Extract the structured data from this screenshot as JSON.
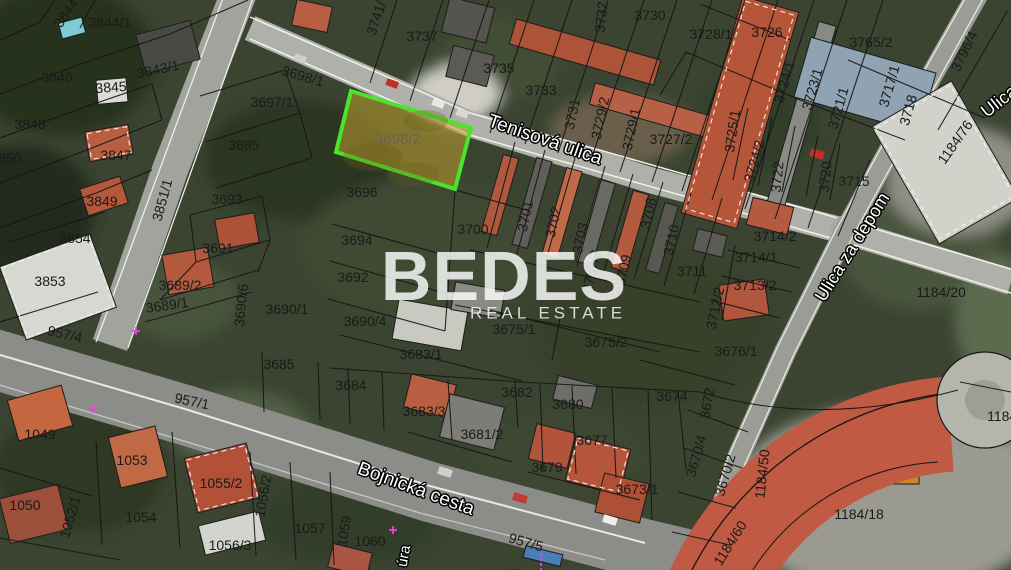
{
  "watermark": {
    "title": "BEDES",
    "subtitle": "REAL ESTATE"
  },
  "map": {
    "highlight": {
      "parcel_id": "3698/2",
      "border_color": "#4be32b",
      "fill_color": "#c0a02e",
      "label_color": "#6e5f4e",
      "polygon": "351,91 471,128 455,189 336,152",
      "label_x": 398,
      "label_y": 139
    },
    "marker_color": "#f03df0",
    "streets": [
      {
        "name": "Tenisová ulica",
        "x": 545,
        "y": 140,
        "r": 19,
        "size": 19
      },
      {
        "name": "Bojnická cesta",
        "x": 416,
        "y": 489,
        "r": 20,
        "size": 19
      },
      {
        "name": "Ulica za depom",
        "x": 852,
        "y": 247,
        "r": -58,
        "size": 18
      },
      {
        "name": "Ulica",
        "x": 999,
        "y": 101,
        "r": -38,
        "size": 18
      },
      {
        "name": "úra",
        "x": 404,
        "y": 556,
        "r": -80,
        "size": 15
      }
    ],
    "parcels": [
      {
        "id": "3844",
        "x": 66,
        "y": 13,
        "r": -55
      },
      {
        "id": "3844/1",
        "x": 110,
        "y": 22,
        "r": 0
      },
      {
        "id": "3843/1",
        "x": 158,
        "y": 69,
        "r": -12
      },
      {
        "id": "3846",
        "x": 57,
        "y": 77,
        "r": 0
      },
      {
        "id": "3845",
        "x": 111,
        "y": 87,
        "r": -4
      },
      {
        "id": "3848",
        "x": 30,
        "y": 124,
        "r": 0
      },
      {
        "id": "3850",
        "x": 6,
        "y": 158,
        "r": 0
      },
      {
        "id": "3847",
        "x": 116,
        "y": 155,
        "r": 0
      },
      {
        "id": "3695",
        "x": 244,
        "y": 145,
        "r": 0
      },
      {
        "id": "3697/1",
        "x": 272,
        "y": 102,
        "r": 0
      },
      {
        "id": "3698/1",
        "x": 303,
        "y": 76,
        "r": 16
      },
      {
        "id": "3851/1",
        "x": 162,
        "y": 200,
        "r": -75
      },
      {
        "id": "3741/",
        "x": 376,
        "y": 18,
        "r": -72
      },
      {
        "id": "3737",
        "x": 422,
        "y": 36,
        "r": 0
      },
      {
        "id": "3735",
        "x": 499,
        "y": 68,
        "r": 0
      },
      {
        "id": "3733",
        "x": 541,
        "y": 90,
        "r": 0
      },
      {
        "id": "3731",
        "x": 572,
        "y": 114,
        "r": -78
      },
      {
        "id": "3732",
        "x": 601,
        "y": 17,
        "r": -84
      },
      {
        "id": "3730",
        "x": 650,
        "y": 15,
        "r": 0
      },
      {
        "id": "3729/2",
        "x": 600,
        "y": 118,
        "r": -78
      },
      {
        "id": "3729/1",
        "x": 631,
        "y": 129,
        "r": -78
      },
      {
        "id": "3727/2",
        "x": 671,
        "y": 139,
        "r": 0
      },
      {
        "id": "3728/1",
        "x": 711,
        "y": 34,
        "r": 0
      },
      {
        "id": "3726",
        "x": 767,
        "y": 32,
        "r": 0
      },
      {
        "id": "3765/2",
        "x": 871,
        "y": 42,
        "r": 0
      },
      {
        "id": "3724/1",
        "x": 784,
        "y": 82,
        "r": -74
      },
      {
        "id": "3723/1",
        "x": 812,
        "y": 89,
        "r": -74
      },
      {
        "id": "3721/1",
        "x": 838,
        "y": 108,
        "r": -74
      },
      {
        "id": "3717/1",
        "x": 889,
        "y": 86,
        "r": -74
      },
      {
        "id": "3718",
        "x": 908,
        "y": 110,
        "r": -74
      },
      {
        "id": "3796/4",
        "x": 964,
        "y": 51,
        "r": -64
      },
      {
        "id": "1184/76",
        "x": 955,
        "y": 142,
        "r": -55
      },
      {
        "id": "3725/1",
        "x": 732,
        "y": 131,
        "r": -82
      },
      {
        "id": "3724/2",
        "x": 754,
        "y": 161,
        "r": -74
      },
      {
        "id": "3722",
        "x": 777,
        "y": 177,
        "r": -84
      },
      {
        "id": "3720",
        "x": 825,
        "y": 177,
        "r": -84
      },
      {
        "id": "3715",
        "x": 854,
        "y": 181,
        "r": 0
      },
      {
        "id": "3696",
        "x": 362,
        "y": 192,
        "r": 0
      },
      {
        "id": "3700",
        "x": 473,
        "y": 229,
        "r": 0
      },
      {
        "id": "3694",
        "x": 357,
        "y": 240,
        "r": 0
      },
      {
        "id": "3692",
        "x": 353,
        "y": 277,
        "r": 0
      },
      {
        "id": "3849",
        "x": 102,
        "y": 201,
        "r": 0
      },
      {
        "id": "3854",
        "x": 75,
        "y": 238,
        "r": 0
      },
      {
        "id": "3853",
        "x": 50,
        "y": 281,
        "r": 0
      },
      {
        "id": "3693",
        "x": 227,
        "y": 199,
        "r": 0
      },
      {
        "id": "3691",
        "x": 218,
        "y": 248,
        "r": 0
      },
      {
        "id": "3689/2",
        "x": 180,
        "y": 285,
        "r": 0
      },
      {
        "id": "3689/1",
        "x": 167,
        "y": 305,
        "r": -8
      },
      {
        "id": "3690/6",
        "x": 241,
        "y": 305,
        "r": -84
      },
      {
        "id": "3690/1",
        "x": 287,
        "y": 309,
        "r": 0
      },
      {
        "id": "957/4",
        "x": 65,
        "y": 334,
        "r": 13
      },
      {
        "id": "3690/4",
        "x": 365,
        "y": 321,
        "r": 0
      },
      {
        "id": "3675/1",
        "x": 514,
        "y": 329,
        "r": 0
      },
      {
        "id": "3675/2",
        "x": 606,
        "y": 342,
        "r": 0
      },
      {
        "id": "3683/1",
        "x": 421,
        "y": 354,
        "r": 0
      },
      {
        "id": "3685",
        "x": 279,
        "y": 364,
        "r": 0
      },
      {
        "id": "3701",
        "x": 525,
        "y": 216,
        "r": -78
      },
      {
        "id": "3702",
        "x": 553,
        "y": 222,
        "r": -78
      },
      {
        "id": "3703",
        "x": 580,
        "y": 238,
        "r": -78
      },
      {
        "id": "3707/2",
        "x": 591,
        "y": 271,
        "r": -78
      },
      {
        "id": "3709",
        "x": 623,
        "y": 270,
        "r": -78
      },
      {
        "id": "3708",
        "x": 648,
        "y": 213,
        "r": -78
      },
      {
        "id": "3710",
        "x": 671,
        "y": 240,
        "r": -78
      },
      {
        "id": "3711",
        "x": 692,
        "y": 271,
        "r": 0
      },
      {
        "id": "3714/2",
        "x": 775,
        "y": 236,
        "r": 0
      },
      {
        "id": "3714/1",
        "x": 756,
        "y": 257,
        "r": 0
      },
      {
        "id": "3713/2",
        "x": 755,
        "y": 285,
        "r": 0
      },
      {
        "id": "3712/2",
        "x": 715,
        "y": 308,
        "r": -78
      },
      {
        "id": "1184/20",
        "x": 941,
        "y": 292,
        "r": 0
      },
      {
        "id": "3676/1",
        "x": 736,
        "y": 351,
        "r": 0
      },
      {
        "id": "957/1",
        "x": 192,
        "y": 401,
        "r": 12
      },
      {
        "id": "1049",
        "x": 40,
        "y": 434,
        "r": 0
      },
      {
        "id": "1053",
        "x": 132,
        "y": 460,
        "r": 0
      },
      {
        "id": "1050",
        "x": 25,
        "y": 505,
        "r": 0
      },
      {
        "id": "1052/1",
        "x": 70,
        "y": 517,
        "r": -74
      },
      {
        "id": "1054",
        "x": 141,
        "y": 517,
        "r": 0
      },
      {
        "id": "1055/2",
        "x": 221,
        "y": 483,
        "r": 0
      },
      {
        "id": "1056/2",
        "x": 263,
        "y": 496,
        "r": -80
      },
      {
        "id": "1056/3",
        "x": 230,
        "y": 545,
        "r": 0
      },
      {
        "id": "1057",
        "x": 310,
        "y": 528,
        "r": 0
      },
      {
        "id": "1059",
        "x": 344,
        "y": 531,
        "r": -80
      },
      {
        "id": "1060",
        "x": 370,
        "y": 541,
        "r": 0
      },
      {
        "id": "3684",
        "x": 351,
        "y": 385,
        "r": 0
      },
      {
        "id": "3683/3",
        "x": 424,
        "y": 411,
        "r": 0
      },
      {
        "id": "3682",
        "x": 517,
        "y": 392,
        "r": 0
      },
      {
        "id": "3681/2",
        "x": 482,
        "y": 434,
        "r": 0
      },
      {
        "id": "3680",
        "x": 568,
        "y": 404,
        "r": 0
      },
      {
        "id": "3679",
        "x": 547,
        "y": 467,
        "r": 0
      },
      {
        "id": "3677",
        "x": 592,
        "y": 440,
        "r": 0
      },
      {
        "id": "3674",
        "x": 672,
        "y": 396,
        "r": 0
      },
      {
        "id": "3673/1",
        "x": 637,
        "y": 489,
        "r": 0
      },
      {
        "id": "3672",
        "x": 707,
        "y": 403,
        "r": -80
      },
      {
        "id": "3670/4",
        "x": 696,
        "y": 456,
        "r": -74
      },
      {
        "id": "3670/2",
        "x": 725,
        "y": 475,
        "r": -74
      },
      {
        "id": "1184/50",
        "x": 762,
        "y": 474,
        "r": -84
      },
      {
        "id": "1184/60",
        "x": 730,
        "y": 543,
        "r": -58
      },
      {
        "id": "1184/18",
        "x": 859,
        "y": 514,
        "r": 0
      },
      {
        "id": "1184/2",
        "x": 1008,
        "y": 416,
        "r": 0
      },
      {
        "id": "957/5",
        "x": 526,
        "y": 542,
        "r": 16
      },
      {
        "id": "1149/2",
        "x": 500,
        "y": 574,
        "r": 0
      }
    ],
    "markers": [
      {
        "x": 93,
        "y": 409,
        "kind": "cross"
      },
      {
        "x": 136,
        "y": 331,
        "kind": "cross"
      },
      {
        "x": 393,
        "y": 530,
        "kind": "cross"
      },
      {
        "x": 541,
        "y": 562,
        "kind": "dash"
      }
    ]
  }
}
